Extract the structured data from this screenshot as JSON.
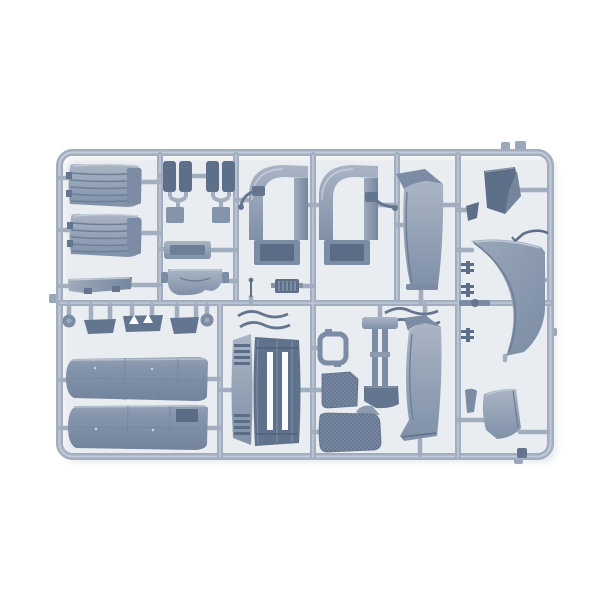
{
  "scene": {
    "type": "product-photo",
    "subject": "Injection-molded plastic model kit sprue with grey truck-cab parts on a white background",
    "background_color": "#ffffff"
  },
  "colors": {
    "background": "#ffffff",
    "frame": "#a2aec0",
    "frame_highlight": "#c3cbd8",
    "frame_shadow": "#7e8ca1",
    "part_base": "#8594ab",
    "part_light": "#b3bdcb",
    "part_mid": "#7b8ca4",
    "part_dark": "#5e7089",
    "part_deep": "#4f617c",
    "texture_dot": "#56globals"
  },
  "sprue": {
    "frame_shape": "rounded rectangle",
    "material": "grey styrene plastic",
    "parts": [
      {
        "name": "ribbed-panel-top",
        "description": "curved ribbed panel, upper left"
      },
      {
        "name": "ribbed-panel-bottom",
        "description": "curved ribbed panel, second upper left"
      },
      {
        "name": "sill-bar",
        "description": "long thin sill strip below ribbed panels"
      },
      {
        "name": "seat-pair-left",
        "description": "pair of dark cushion slabs"
      },
      {
        "name": "seat-pair-right",
        "description": "pair of dark cushion slabs"
      },
      {
        "name": "storage-tray",
        "description": "rectangular tray with recess"
      },
      {
        "name": "dashboard-bracket",
        "description": "curved bracket piece"
      },
      {
        "name": "wheel-arch-left",
        "description": "large C-shaped wheel arch with socket foot"
      },
      {
        "name": "wheel-arch-right",
        "description": "large C-shaped wheel arch with socket foot"
      },
      {
        "name": "mirror-arm-left",
        "description": "small mirror arm with pad"
      },
      {
        "name": "mirror-arm-right",
        "description": "small mirror arm with pad"
      },
      {
        "name": "antenna-part",
        "description": "thin antenna with ball tip"
      },
      {
        "name": "slotted-block",
        "description": "small dark block with vertical slits"
      },
      {
        "name": "side-deflector-upper",
        "description": "tall curved cab side deflector, upper row"
      },
      {
        "name": "dark-corner-vane",
        "description": "dark angled vane, top right"
      },
      {
        "name": "corner-wind-deflector",
        "description": "large curved corner wind deflector, right"
      },
      {
        "name": "wiper-blade",
        "description": "thin bent wiper strip"
      },
      {
        "name": "lower-corner-panel",
        "description": "small curved panel, bottom right"
      },
      {
        "name": "roof-panel-front",
        "description": "large flat roof panel, bottom left"
      },
      {
        "name": "roof-panel-rear",
        "description": "large flat roof panel with dark notch"
      },
      {
        "name": "bracket-row",
        "description": "row of small mudflap brackets and round caps"
      },
      {
        "name": "front-grille",
        "description": "front grille with three dark vertical slats"
      },
      {
        "name": "step-frame",
        "description": "small open rectangular step frame"
      },
      {
        "name": "tread-plate-small",
        "description": "small diamond-tread plate"
      },
      {
        "name": "tread-plate-large",
        "description": "large diamond-tread plate with corner tab"
      },
      {
        "name": "chassis-stand",
        "description": "vertical twin-prong stand with foot"
      },
      {
        "name": "side-deflector-lower",
        "description": "tall curved cab side deflector, lower row"
      },
      {
        "name": "trim-strips",
        "description": "thin wavy trim strips"
      },
      {
        "name": "rail-clips",
        "description": "small bolt clips on right runner"
      },
      {
        "name": "sprue-frame",
        "description": "outer rounded runner frame with gates and tabs"
      }
    ]
  }
}
